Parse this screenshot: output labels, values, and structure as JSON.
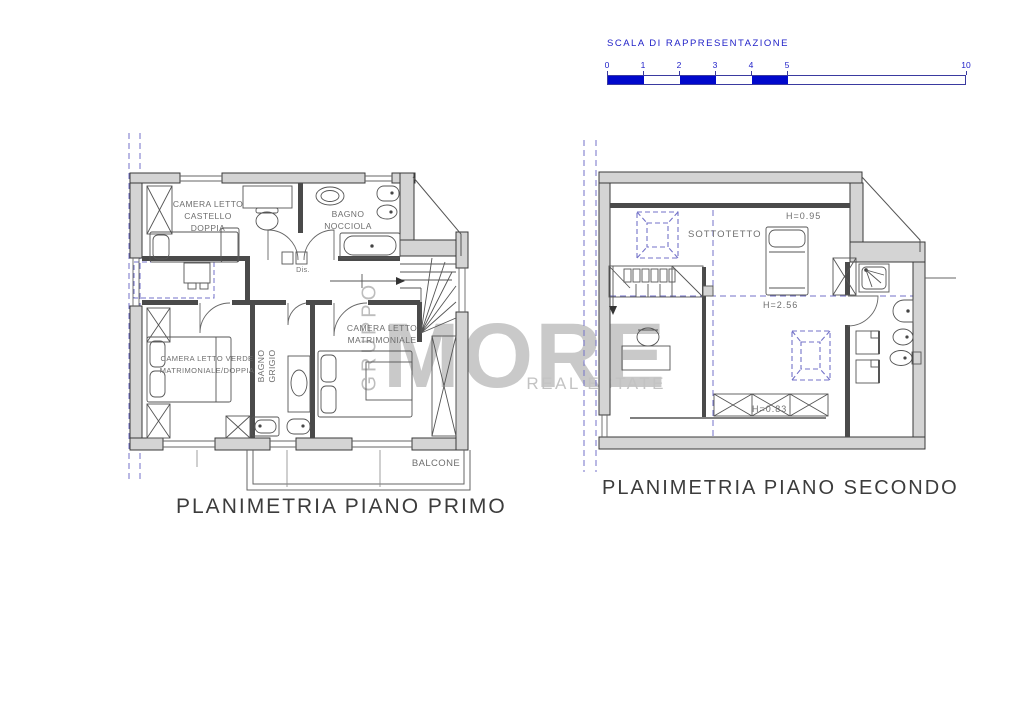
{
  "scale_bar": {
    "title": "SCALA  DI  RAPPRESENTAZIONE",
    "ticks": [
      "0",
      "1",
      "2",
      "3",
      "4",
      "5",
      "10"
    ],
    "bar_color": "#0008cc",
    "text_color": "#2222c8"
  },
  "watermark": {
    "vertical": "GRUPPO",
    "brand": "MORE",
    "tagline": "REAL ESTATE",
    "color": "#c9c9c9"
  },
  "first_floor": {
    "title": "PLANIMETRIA PIANO PRIMO",
    "labels": {
      "camera_castello": [
        "CAMERA LETTO",
        "CASTELLO",
        "DOPPIA"
      ],
      "bagno_nocciola": [
        "BAGNO",
        "NOCCIOLA"
      ],
      "disimpegno": "Dis.",
      "camera_matrimoniale": [
        "CAMERA LETTO",
        "MATRIMONIALE"
      ],
      "camera_verde": [
        "CAMERA LETTO VERDE",
        "MATRIMONIALE/DOPPIA"
      ],
      "bagno_grigio": [
        "BAGNO",
        "GRIGIO"
      ],
      "balcone": "BALCONE"
    }
  },
  "second_floor": {
    "title": "PLANIMETRIA PIANO SECONDO",
    "labels": {
      "sottotetto": "SOTTOTETTO",
      "height_top": "H=0.95",
      "height_mid": "H=2.56",
      "height_low": "H=0.83"
    }
  },
  "colors": {
    "wall_fill": "#d4d4d4",
    "wall_stroke": "#3a3a3a",
    "partition": "#4a4a4a",
    "dashed_line": "#7372c8",
    "label_text": "#6e6e6e",
    "title_text": "#3c3c3c"
  }
}
